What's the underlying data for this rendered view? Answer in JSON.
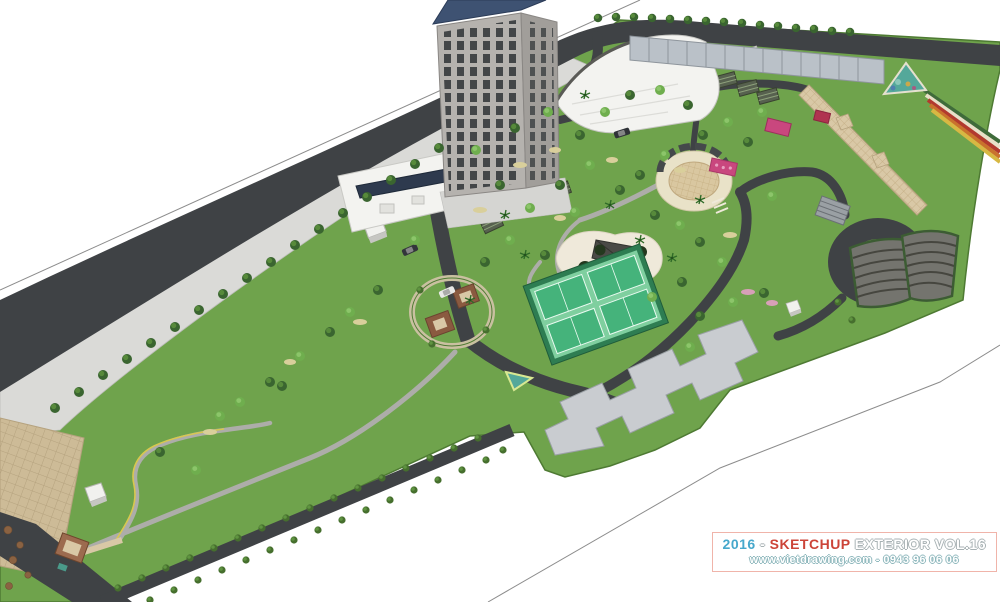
{
  "watermark": {
    "year": "2016",
    "separator": " - ",
    "brand": "SKETCHUP",
    "title_rest": " EXTERIOR VOL.16",
    "website_line": "www.vietdrawing.com - 0943 96 06 06"
  },
  "palette": {
    "sky": "#ffffff",
    "lawn": "#6fa34c",
    "lawn_dark": "#5d8f3f",
    "road": "#3f4245",
    "pavement": "#dadad7",
    "tile": "#cdbb97",
    "tan_path": "#d9c8a6",
    "tower_face": "#b5b2ae",
    "tower_side": "#a19e9a",
    "roof_blue": "#3e5272",
    "window_dark": "#3d4043",
    "white_roof": "#f3f3f0",
    "fence": "#bac1c8",
    "court_green": "#45b37b",
    "court_light": "#7fcf9f",
    "court_border": "#2e7d52",
    "sand": "#efe9da",
    "water": "#54a89a",
    "pink": "#c9477e",
    "amphitheater": "#74746e",
    "slab": "#c9ccd0",
    "wm_year": "#46a8cc",
    "wm_brand": "#cc4438"
  }
}
